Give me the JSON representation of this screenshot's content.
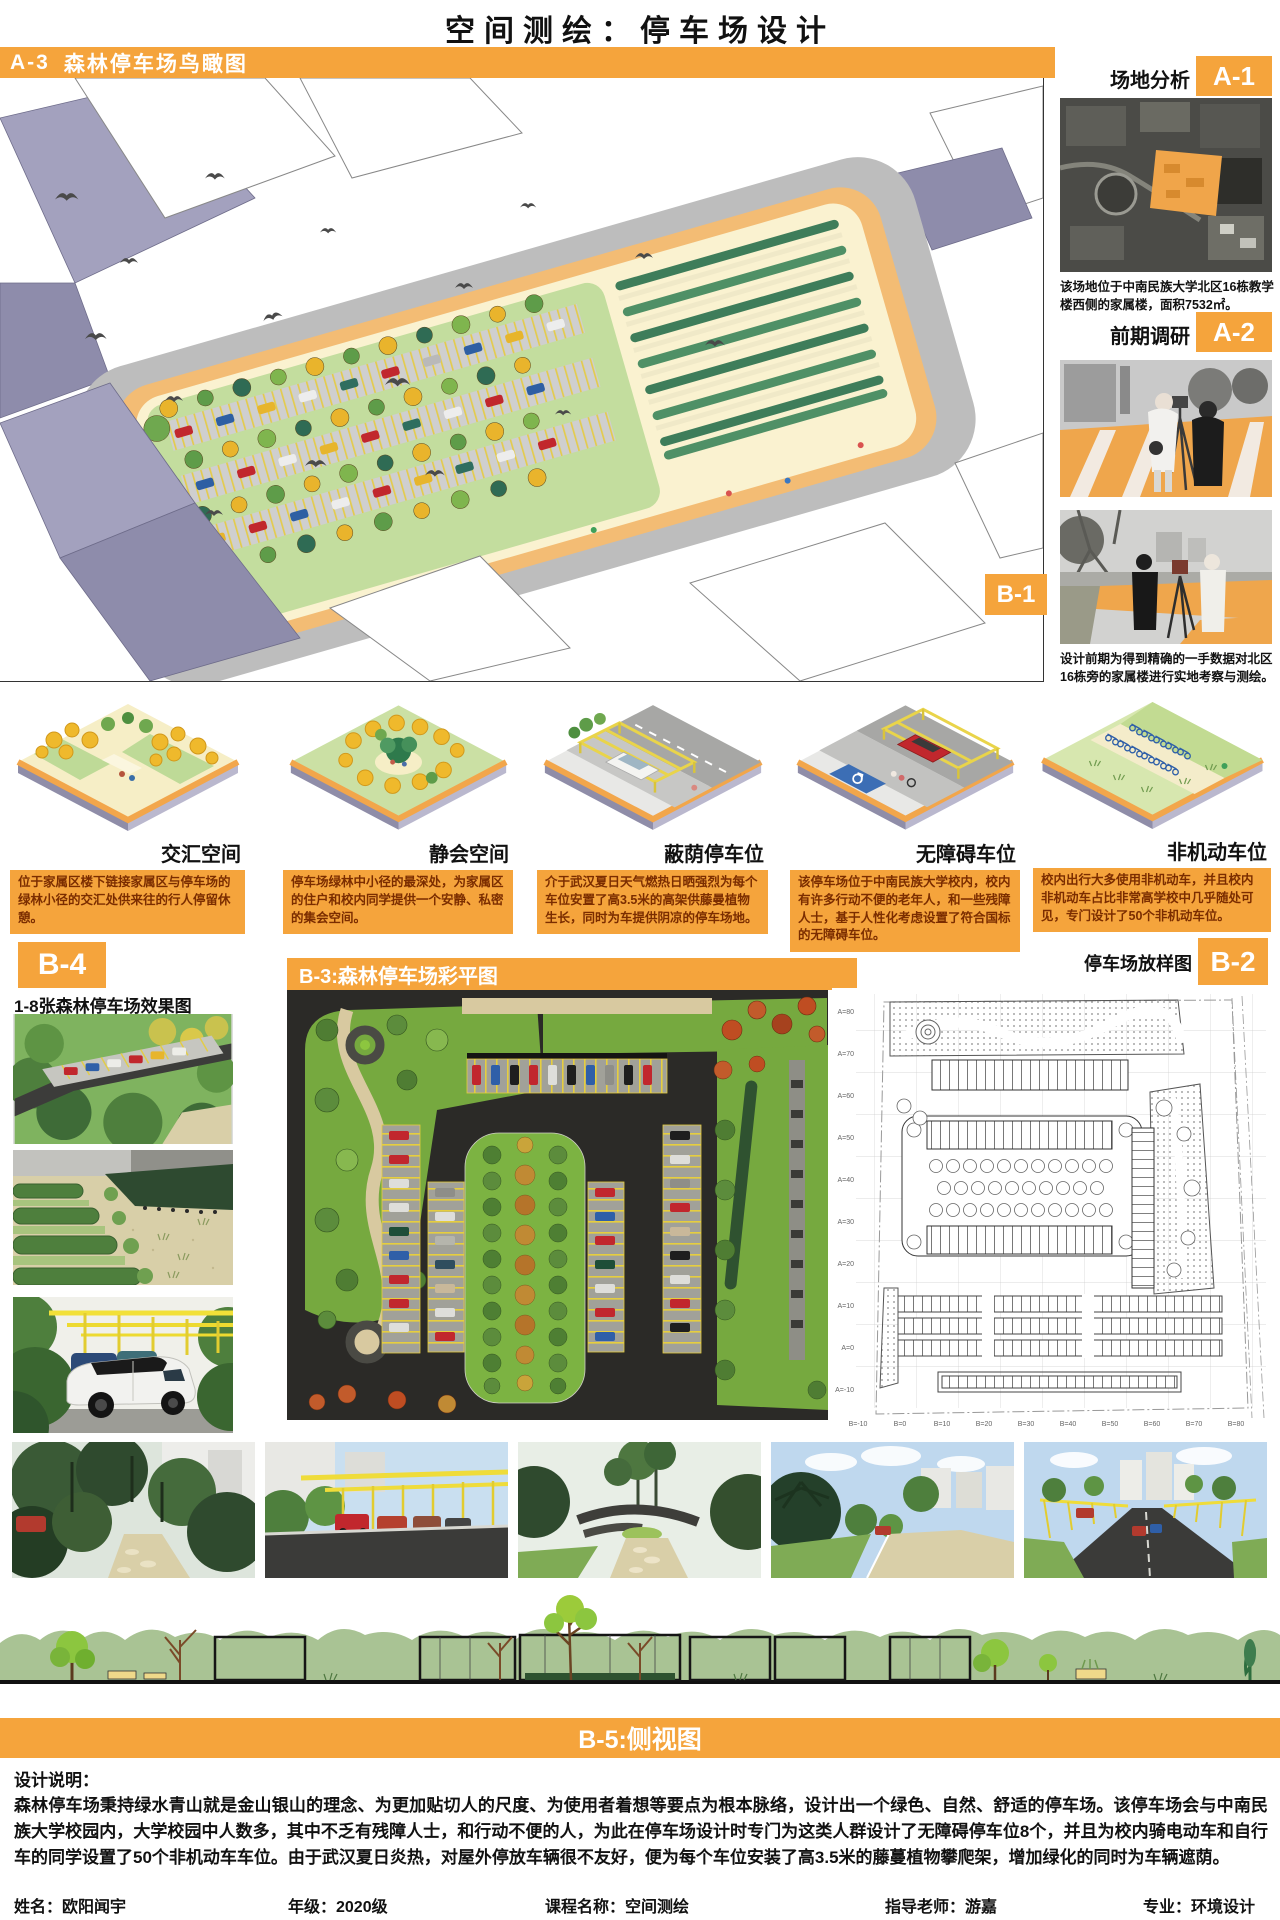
{
  "accent": "#F5A43C",
  "header": {
    "title": "空间测绘：停车场设计"
  },
  "a3": {
    "badge": "A-3",
    "title": "森林停车场鸟瞰图"
  },
  "a1": {
    "badge": "A-1",
    "title": "场地分析",
    "caption": "该场地位于中南民族大学北区16栋教学楼西侧的家属楼，面积7532㎡。"
  },
  "a2": {
    "badge": "A-2",
    "title": "前期调研",
    "caption": "设计前期为得到精确的一手数据对北区16栋旁的家属楼进行实地考察与测绘。"
  },
  "b1": {
    "badge": "B-1",
    "items": [
      {
        "label": "交汇空间",
        "desc": "位于家属区楼下链接家属区与停车场的绿林小径的交汇处供来往的行人停留休憩。"
      },
      {
        "label": "静会空间",
        "desc": "停车场绿林中小径的最深处，为家属区的住户和校内同学提供一个安静、私密的集会空间。"
      },
      {
        "label": "蔽荫停车位",
        "desc": "介于武汉夏日天气燃热日晒强烈为每个车位安置了高3.5米的高架供藤曼植物生长，同时为车提供阴凉的停车场地。"
      },
      {
        "label": "无障碍车位",
        "desc": "该停车场位于中南民族大学校内，校内有许多行动不便的老年人，和一些残障人士，基于人性化考虑设置了符合国标的无障碍车位。"
      },
      {
        "label": "非机动车位",
        "desc": "校内出行大多使用非机动车，并且校内非机动车占比非常高学校中几乎随处可见，专门设计了50个非机动车位。"
      }
    ]
  },
  "b4": {
    "badge": "B-4",
    "title": "1-8张森林停车场效果图"
  },
  "b3": {
    "banner": "B-3:森林停车场彩平图"
  },
  "b2": {
    "badge": "B-2",
    "title": "停车场放样图",
    "axis_left": [
      "A=80",
      "A=70",
      "A=60",
      "A=50",
      "A=40",
      "A=30",
      "A=20",
      "A=10",
      "A=0",
      "A=-10"
    ],
    "axis_bottom": [
      "B=-10",
      "B=0",
      "B=10",
      "B=20",
      "B=30",
      "B=40",
      "B=50",
      "B=60",
      "B=70",
      "B=80"
    ]
  },
  "b5": {
    "banner": "B-5:侧视图"
  },
  "notes": {
    "heading": "设计说明：",
    "body": "森林停车场秉持绿水青山就是金山银山的理念、为更加贴切人的尺度、为使用者着想等要点为根本脉络，设计出一个绿色、自然、舒适的停车场。该停车场会与中南民族大学校园内，大学校园中人数多，其中不乏有残障人士，和行动不便的人，为此在停车场设计时专门为这类人群设计了无障碍停车位8个，并且为校内骑电动车和自行车的同学设置了50个非机动车车位。由于武汉夏日炎热，对屋外停放车辆很不友好，便为每个车位安装了高3.5米的藤蔓植物攀爬架，增加绿化的同时为车辆遮荫。"
  },
  "footer": {
    "name": "姓名：欧阳闻宇",
    "grade": "年级：2020级",
    "course": "课程名称：空间测绘",
    "advisor": "指导老师：游嘉",
    "major": "专业：环境设计"
  }
}
